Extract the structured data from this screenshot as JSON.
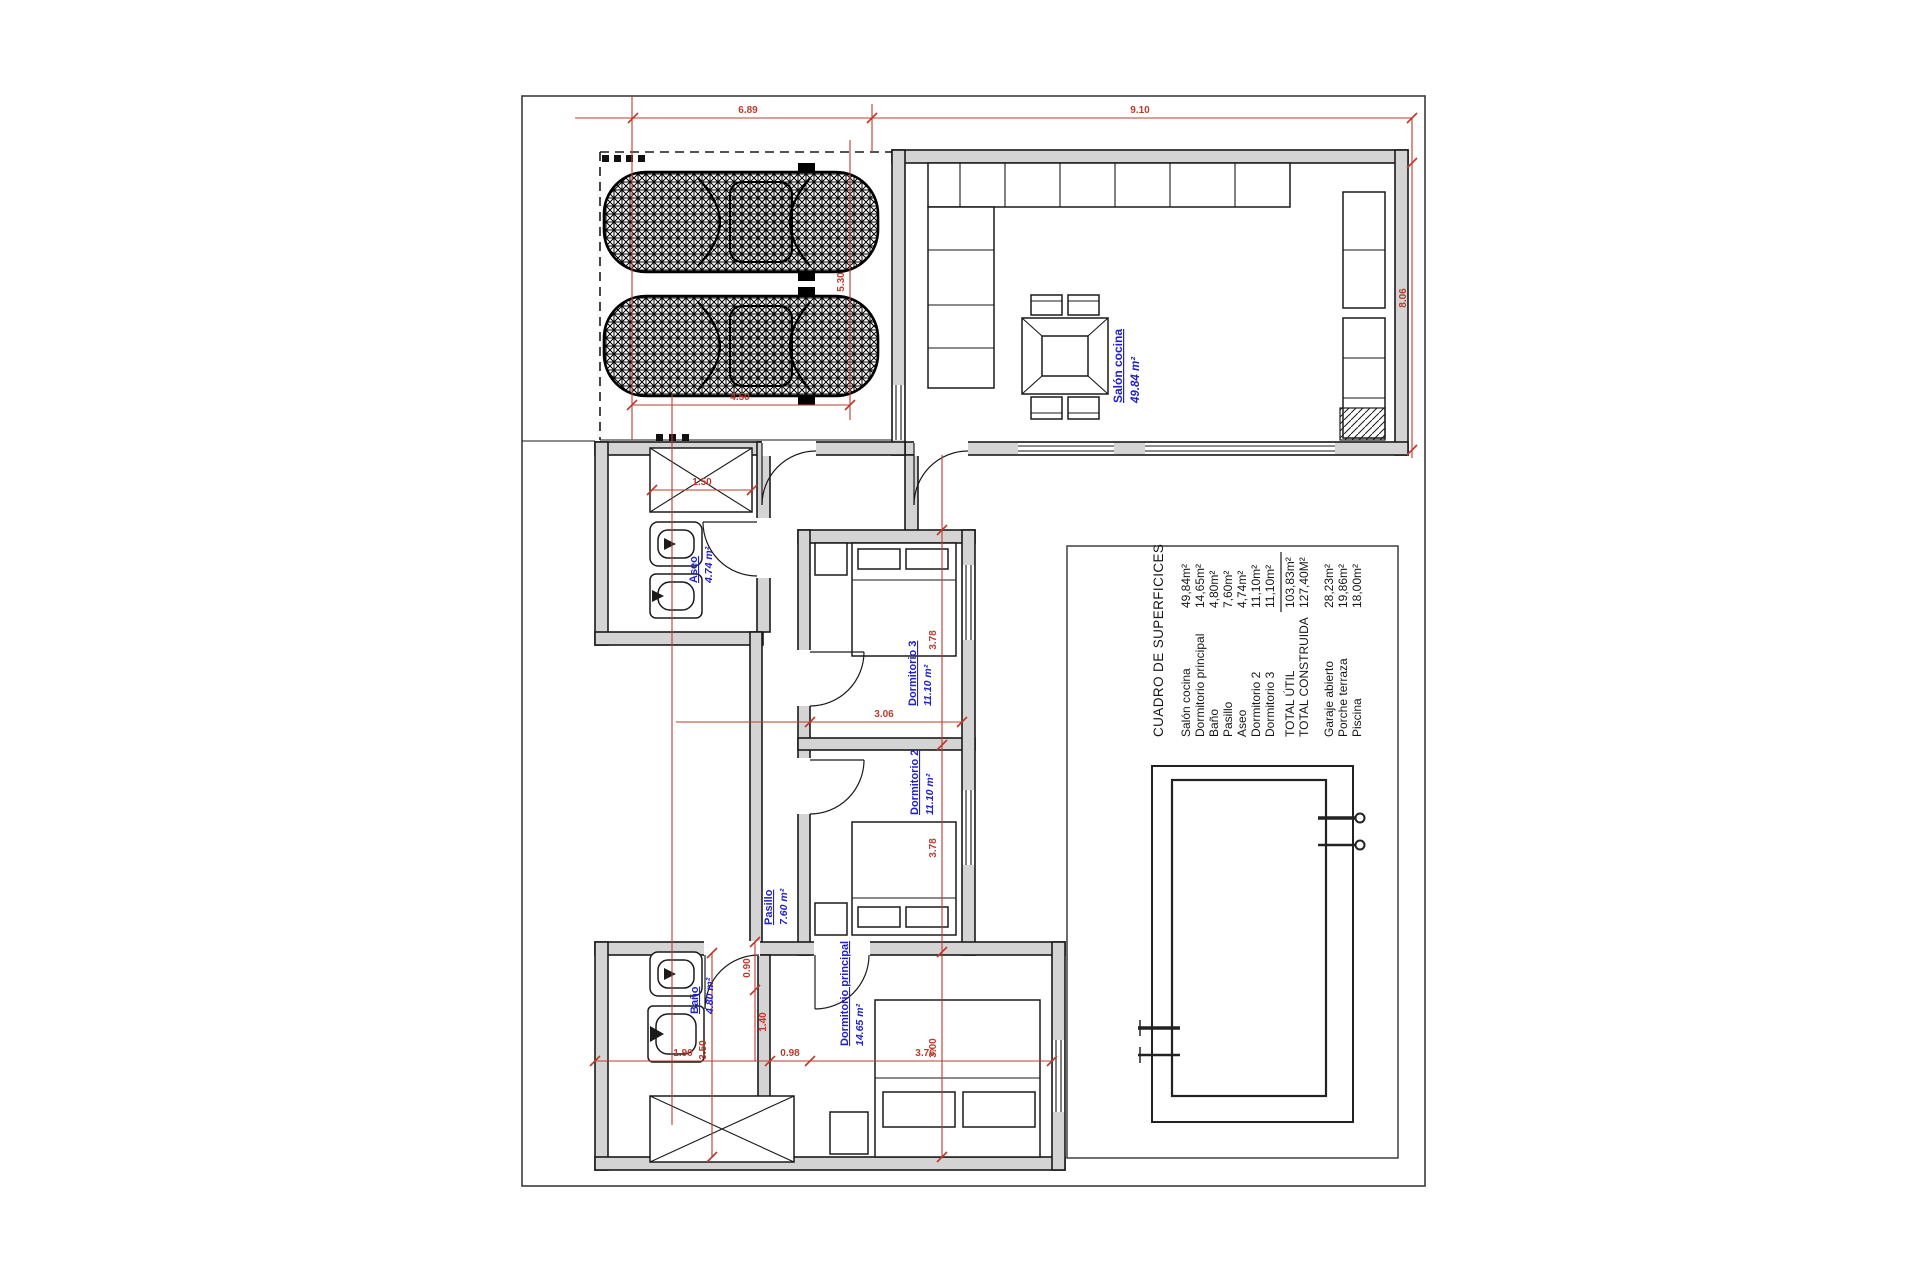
{
  "colors": {
    "dimension_red": "#c0392b",
    "label_blue": "#2121c8",
    "wall_gray": "#d4d4d4"
  },
  "surface_table": {
    "title": "CUADRO DE SUPERFICICES",
    "rows": [
      {
        "name": "Salón cocina",
        "value": "49,84m²"
      },
      {
        "name": "Dormitorio principal",
        "value": "14,65m²"
      },
      {
        "name": "Baño",
        "value": "4,80m²"
      },
      {
        "name": "Pasillo",
        "value": "7,60m²"
      },
      {
        "name": "Aseo",
        "value": "4,74m²"
      },
      {
        "name": "Dormitorio 2",
        "value": "11,10m²"
      },
      {
        "name": "Dormitorio 3",
        "value": "11,10m²"
      }
    ],
    "totals": [
      {
        "name": "TOTAL ÚTIL",
        "value": "103,83m²"
      },
      {
        "name": "TOTAL CONSTRUIDA",
        "value": "127,40M²"
      }
    ],
    "outdoor": [
      {
        "name": "Garaje abierto",
        "value": "28,23m²"
      },
      {
        "name": "Porche terraza",
        "value": "19,86m²"
      },
      {
        "name": "Piscina",
        "value": "18,00m²"
      }
    ]
  },
  "room_labels": [
    {
      "name": "Salón cocina",
      "area": "49.84 m²"
    },
    {
      "name": "Aseo",
      "area": "4.74 m²"
    },
    {
      "name": "Dormitorio 3",
      "area": "11.10 m²"
    },
    {
      "name": "Dormitorio 2",
      "area": "11.10 m²"
    },
    {
      "name": "Pasillo",
      "area": "7.60 m²"
    },
    {
      "name": "Baño",
      "area": "4.80 m²"
    },
    {
      "name": "Dormitorio principal",
      "area": "14.65 m²"
    }
  ],
  "dimensions": [
    "6.89",
    "9.10",
    "8.06",
    "5.30",
    "4.50",
    "1.50",
    "3.06",
    "3.78",
    "3.78",
    "0.90",
    "1.90",
    "0.98",
    "3.76",
    "3.00",
    "3.50",
    "1.40"
  ]
}
